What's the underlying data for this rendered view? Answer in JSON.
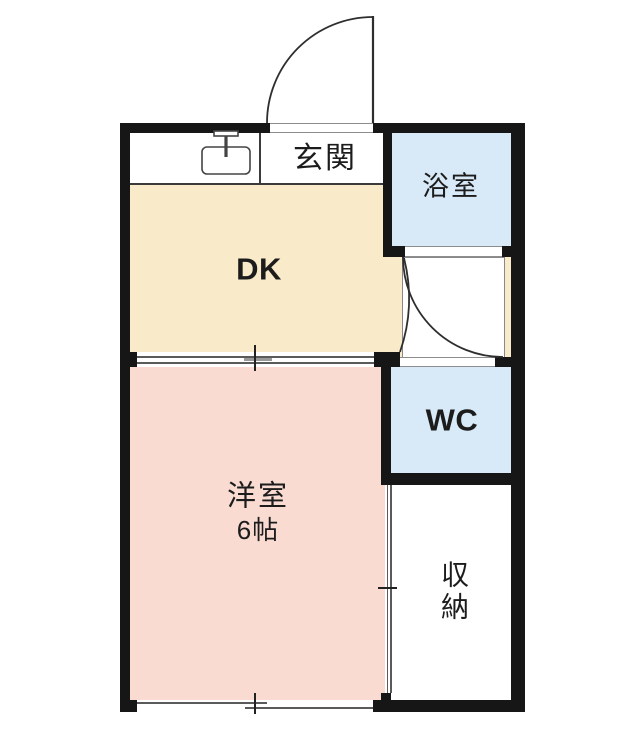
{
  "plan": {
    "rooms": {
      "genkan": {
        "label": "玄関"
      },
      "dk": {
        "label": "DK"
      },
      "bathroom": {
        "label": "浴室"
      },
      "wc": {
        "label": "WC"
      },
      "western": {
        "label": "洋室",
        "size": "6帖"
      },
      "storage": {
        "label": "収納"
      }
    },
    "colors": {
      "wall": "#161616",
      "dk_fill": "#f9ebc9",
      "western_fill": "#f9dbd2",
      "water_fill": "#d8e9f7",
      "line_dark": "#3a3a3a",
      "line_light": "#8d8d8d"
    }
  }
}
